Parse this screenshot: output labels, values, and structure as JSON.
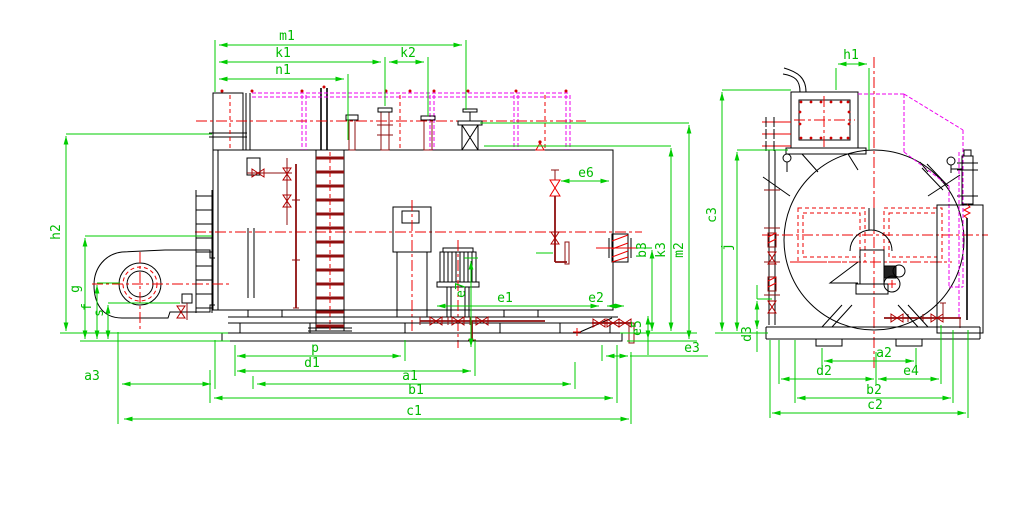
{
  "drawing": {
    "title": "Fire-tube boiler general arrangement drawing",
    "views": {
      "side_elevation": {
        "name": "side-elevation",
        "dimension_labels": [
          "m1",
          "k1",
          "k2",
          "n1",
          "h2",
          "g",
          "f",
          "s",
          "a3",
          "p",
          "d1",
          "a1",
          "b1",
          "c1",
          "e1",
          "e2",
          "e3",
          "e5",
          "e6",
          "e7",
          "b3",
          "k3",
          "m2"
        ]
      },
      "end_elevation": {
        "name": "end-elevation",
        "dimension_labels": [
          "h1",
          "c3",
          "j",
          "d3",
          "a2",
          "d2",
          "e4",
          "b2",
          "c2"
        ]
      }
    }
  },
  "labels": {
    "m1": "m1",
    "k1": "k1",
    "k2": "k2",
    "n1": "n1",
    "h2": "h2",
    "g": "g",
    "f": "f",
    "s": "s",
    "a3": "a3",
    "p": "p",
    "d1": "d1",
    "a1": "a1",
    "b1": "b1",
    "c1": "c1",
    "e1": "e1",
    "e2": "e2",
    "e3": "e3",
    "e5": "e5",
    "e6": "e6",
    "e7": "e7",
    "b3": "b3",
    "k3": "k3",
    "m2": "m2",
    "h1": "h1",
    "c3": "c3",
    "j": "j",
    "d3": "d3",
    "a2": "a2",
    "d2": "d2",
    "e4": "e4",
    "b2": "b2",
    "c2": "c2"
  },
  "colors": {
    "dimension_green": "#00cc00",
    "centerline_red": "#ee0000",
    "pipe_dark_red": "#8f1010",
    "duct_magenta": "#ee00ee",
    "outline_black": "#000000",
    "background": "#ffffff"
  }
}
